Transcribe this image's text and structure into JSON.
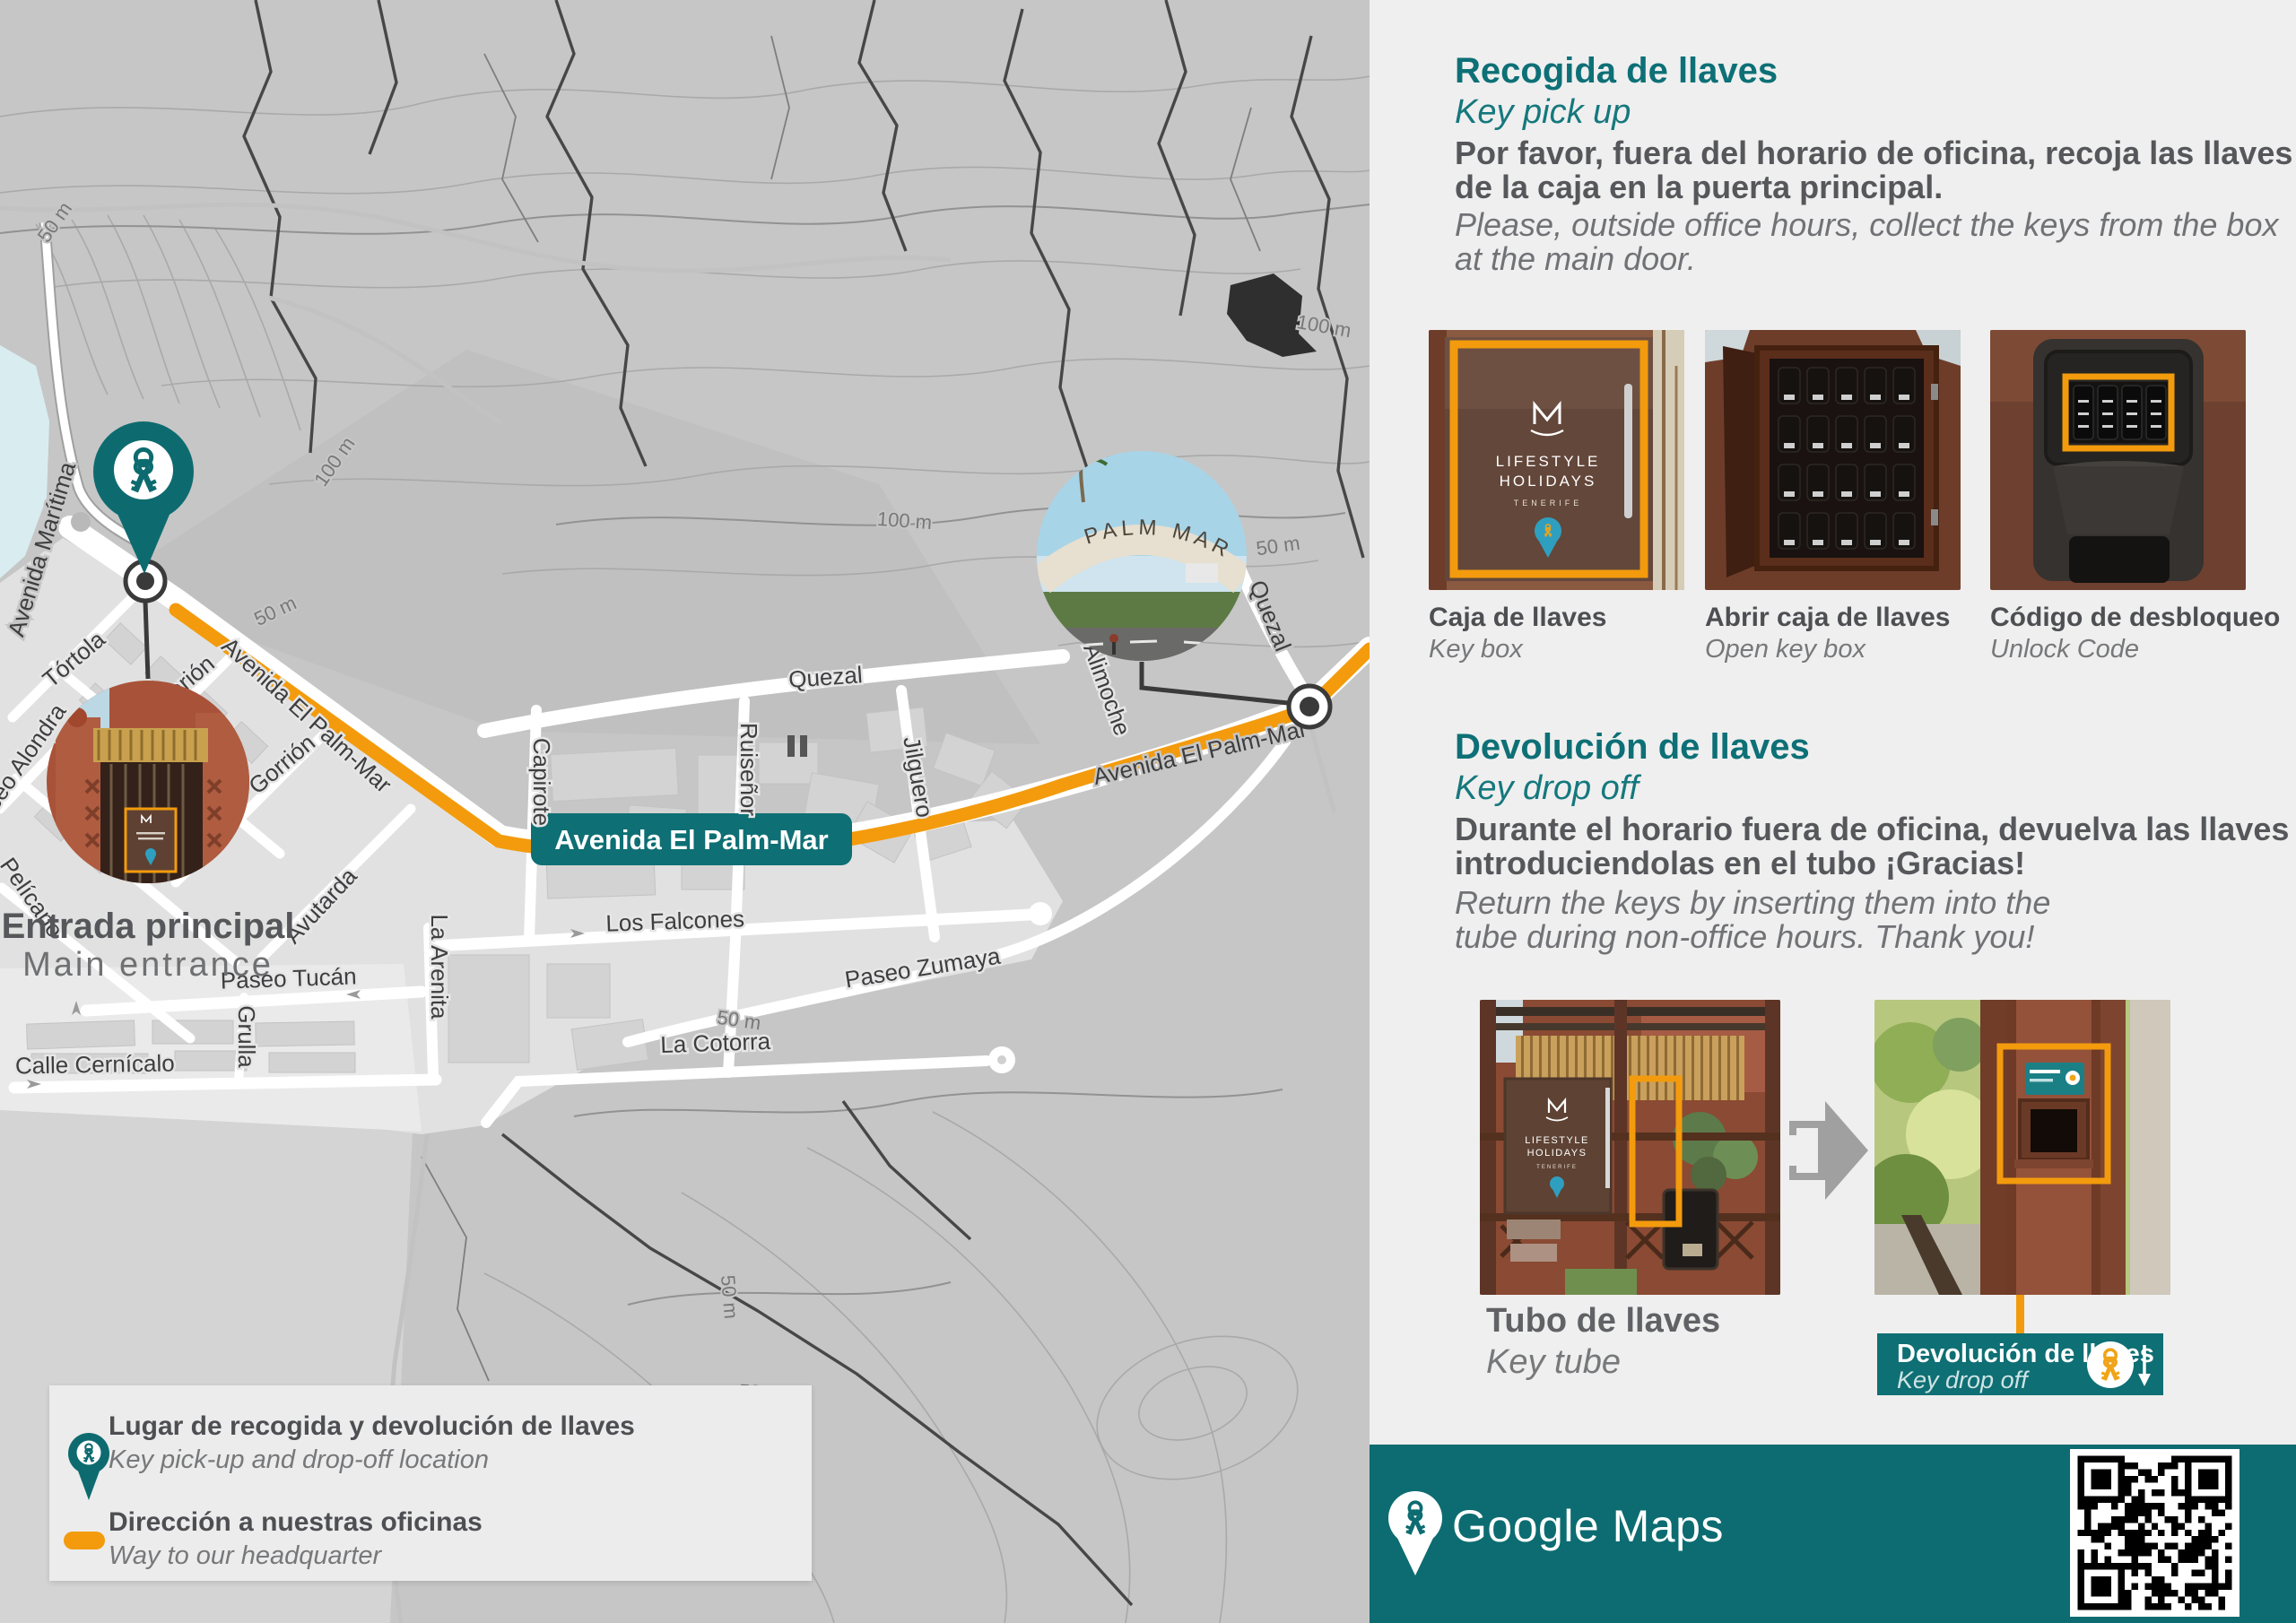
{
  "map": {
    "streets": {
      "avenida_maritima": "Avenida Marítima",
      "tortola": "Tórtola",
      "gorion": "Gorión",
      "gorrion": "Gorrión",
      "pelicano": "Pelícano",
      "paseo_alondra": "Paseo Alondra",
      "avutarda": "Avutarda",
      "la_arenita": "La Arenita",
      "grulla": "Grulla",
      "paseo_tucan": "Paseo Tucán",
      "calle_cernicalo": "Calle Cernícalo",
      "quezal": "Quezal",
      "capirote": "Capirote",
      "ruisenor": "Ruiseñor",
      "jilguero": "Jilguero",
      "los_falcones": "Los Falcones",
      "paseo_zumaya": "Paseo Zumaya",
      "la_cotorra": "La Cotorra",
      "alimoche": "Alimoche",
      "avenida_el_palm_mar": "Avenida El Palm-Mar"
    },
    "route_badge": "Avenida El Palm-Mar",
    "contour_labels": {
      "c50": "50 m",
      "c100": "100 m"
    },
    "entrance_label": {
      "es": "Entrada principal",
      "en": "Main entrance"
    },
    "palm_mar_arch": "PALM MAR",
    "legend": {
      "items": [
        {
          "title": "Lugar de recogida y devolución de llaves",
          "subtitle": "Key pick-up and drop-off location"
        },
        {
          "title": "Dirección a nuestras oficinas",
          "subtitle": "Way to our headquarter"
        }
      ]
    }
  },
  "panel": {
    "pickup": {
      "title": "Recogida de llaves",
      "subtitle": "Key pick up",
      "body_es": "Por favor, fuera del horario de oficina, recoja las llaves de la caja en la puerta principal.",
      "body_en": "Please, outside office hours, collect the keys from the box at the main door.",
      "photos": [
        {
          "caption_es": "Caja de llaves",
          "caption_en": "Key box"
        },
        {
          "caption_es": "Abrir caja de llaves",
          "caption_en": "Open key box"
        },
        {
          "caption_es": "Código de desbloqueo",
          "caption_en": "Unlock Code"
        }
      ]
    },
    "dropoff": {
      "title": "Devolución de llaves",
      "subtitle": "Key drop off",
      "body_es": "Durante el horario fuera de oficina, devuelva las llaves introduciendolas en el tubo ¡Gracias!",
      "body_en": "Return the keys by inserting them into the tube during non-office hours. Thank you!",
      "photo_caption_es": "Tubo de llaves",
      "photo_caption_en": "Key tube",
      "badge": {
        "title": "Devolución de llaves",
        "subtitle": "Key drop off"
      }
    }
  },
  "branding": {
    "sign": {
      "line1": "LIFESTYLE",
      "line2": "HOLIDAYS",
      "line3": "TENERIFE"
    },
    "footer_brand": "Google Maps"
  },
  "colors": {
    "teal": "#0e6f74",
    "orange": "#f39b0d"
  }
}
